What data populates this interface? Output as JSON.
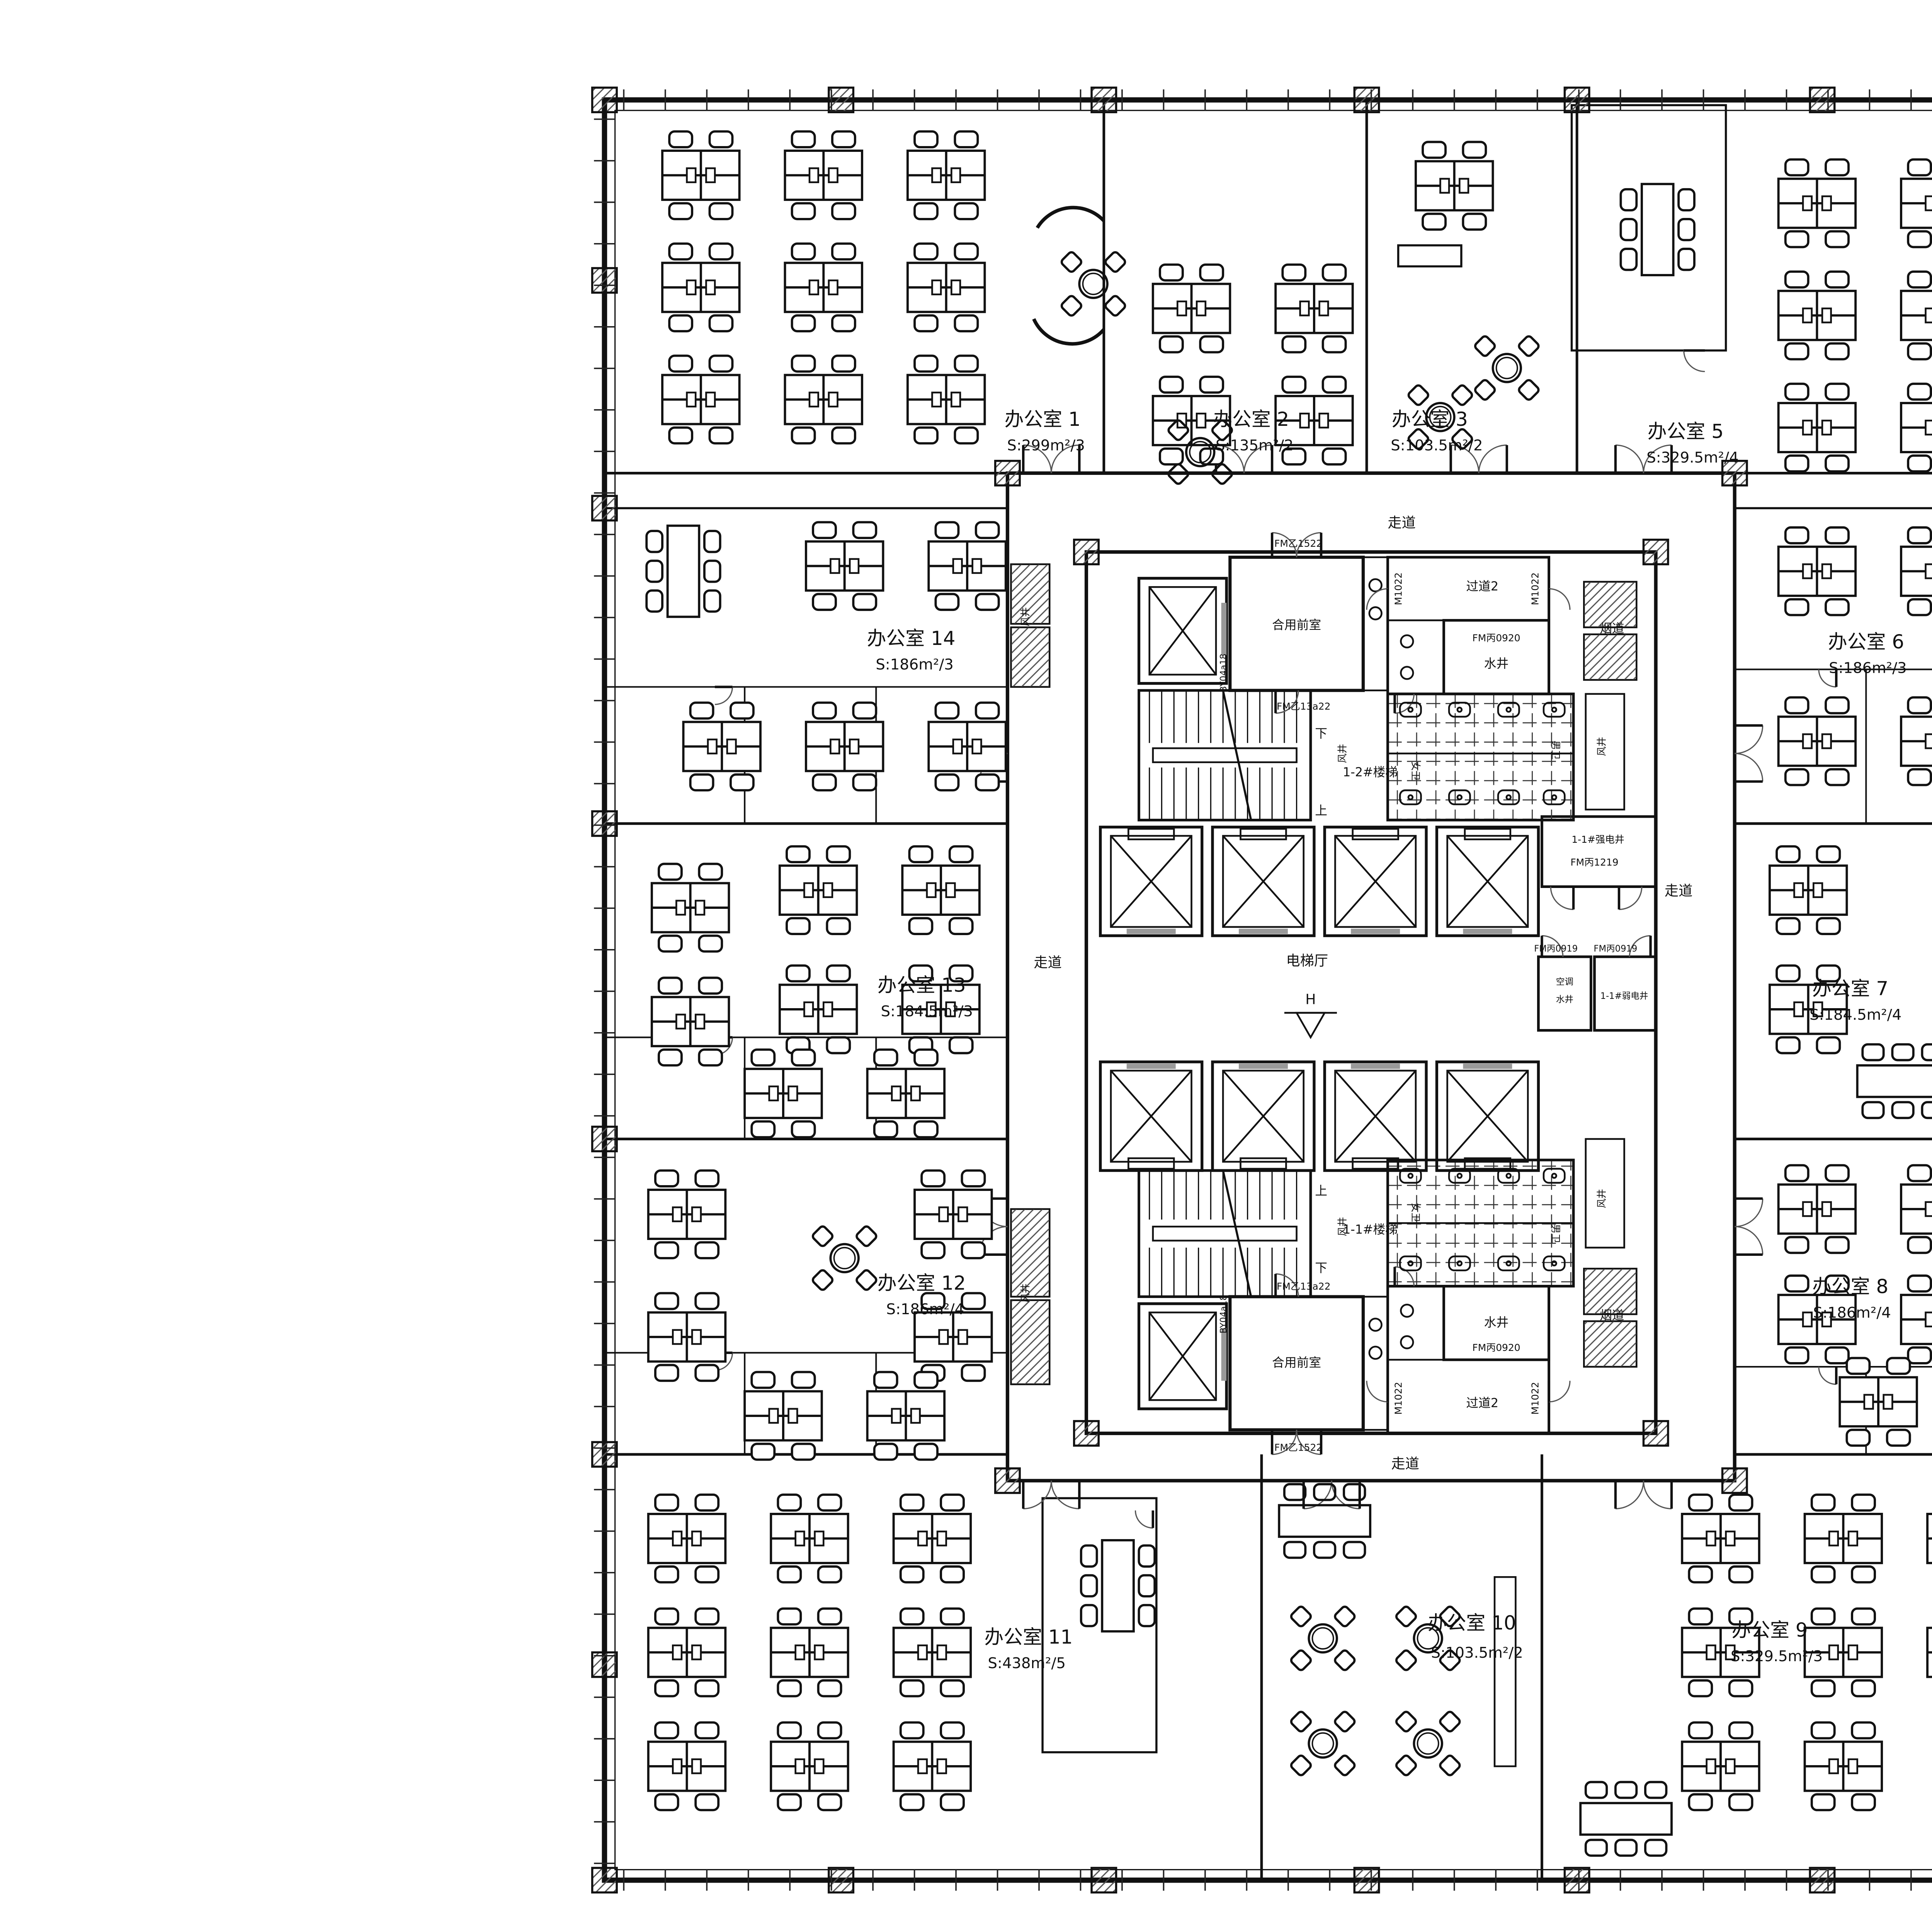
{
  "colors": {
    "ink": "#111111",
    "paper": "#ffffff",
    "door_arc": "#555555",
    "glass": "#999999"
  },
  "rooms": [
    {
      "name": "办公室 1",
      "area": "S:299m²/3"
    },
    {
      "name": "办公室 2",
      "area": "S:135m²/2"
    },
    {
      "name": "办公室 3",
      "area": "S:103.5m²/2"
    },
    {
      "name": "办公室 5",
      "area": "S:329.5m²/4"
    },
    {
      "name": "办公室 6",
      "area": "S:186m²/3"
    },
    {
      "name": "办公室 7",
      "area": "S:184.5m²/4"
    },
    {
      "name": "办公室 8",
      "area": "S:186m²/4"
    },
    {
      "name": "办公室 9",
      "area": "S:329.5m²/3"
    },
    {
      "name": "办公室 10",
      "area": "S:103.5m²/2"
    },
    {
      "name": "办公室 11",
      "area": "S:438m²/5"
    },
    {
      "name": "办公室 12",
      "area": "S:186m²/4"
    },
    {
      "name": "办公室 13",
      "area": "S:184.5m²/3"
    },
    {
      "name": "办公室 14",
      "area": "S:186m²/3"
    }
  ],
  "corridors": {
    "walkway": "走道",
    "passage2": "过道2"
  },
  "core": {
    "elevator_hall": "电梯厅",
    "hall_mark": "H",
    "shared_front_room": "合用前室",
    "stair_1_2": "1-2#楼梯",
    "stair_1_1": "1-1#楼梯",
    "up": "上",
    "down": "下",
    "wind_shaft": "风井",
    "water_shaft": "水井",
    "smoke_duct": "烟道",
    "strong_electric_shaft": "1-1#强电井",
    "weak_electric_shaft": "1-1#弱电井",
    "ac_water_shaft_line1": "空调",
    "ac_water_shaft_line2": "水井",
    "female_wc": "女卫",
    "male_wc": "男卫"
  },
  "doors": {
    "fm_yi_1522": "FM乙1522",
    "fm_yi_13a22": "FM乙13a22",
    "fm_bing_0920": "FM丙0920",
    "fm_bing_1219": "FM丙1219",
    "fm_bing_0919": "FM丙0919",
    "m1022": "M1022",
    "m0921": "M0921",
    "louver_by": "BY04a18"
  },
  "dimensions": {
    "right_bottom": "2365"
  }
}
